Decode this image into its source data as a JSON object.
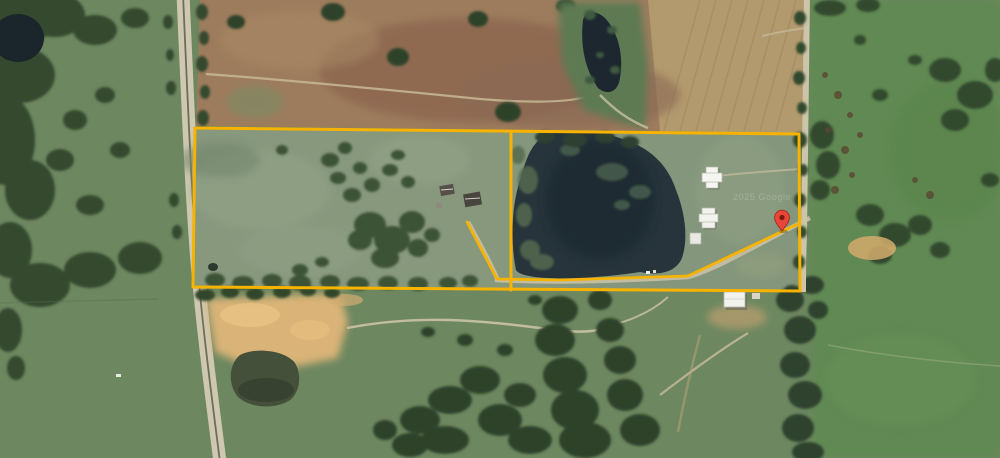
{
  "map": {
    "type": "satellite-aerial-parcel-view",
    "watermark": "2025 Google",
    "colors": {
      "boundary": "#F6B301",
      "pin_fill": "#E8463A",
      "pin_dot": "#7E180F",
      "pond": "#27343B",
      "field_brown": "#9D7C5D",
      "pasture_green": "#6D8760"
    },
    "boundary": {
      "outer_points": "195,128 799,134 800,291 193,287 195,128",
      "divider_points": "511,131 511,290",
      "driveway_points": "467,222 497,279 560,280 688,276 800,223"
    },
    "pin": {
      "transform": "translate(782,231)"
    }
  }
}
